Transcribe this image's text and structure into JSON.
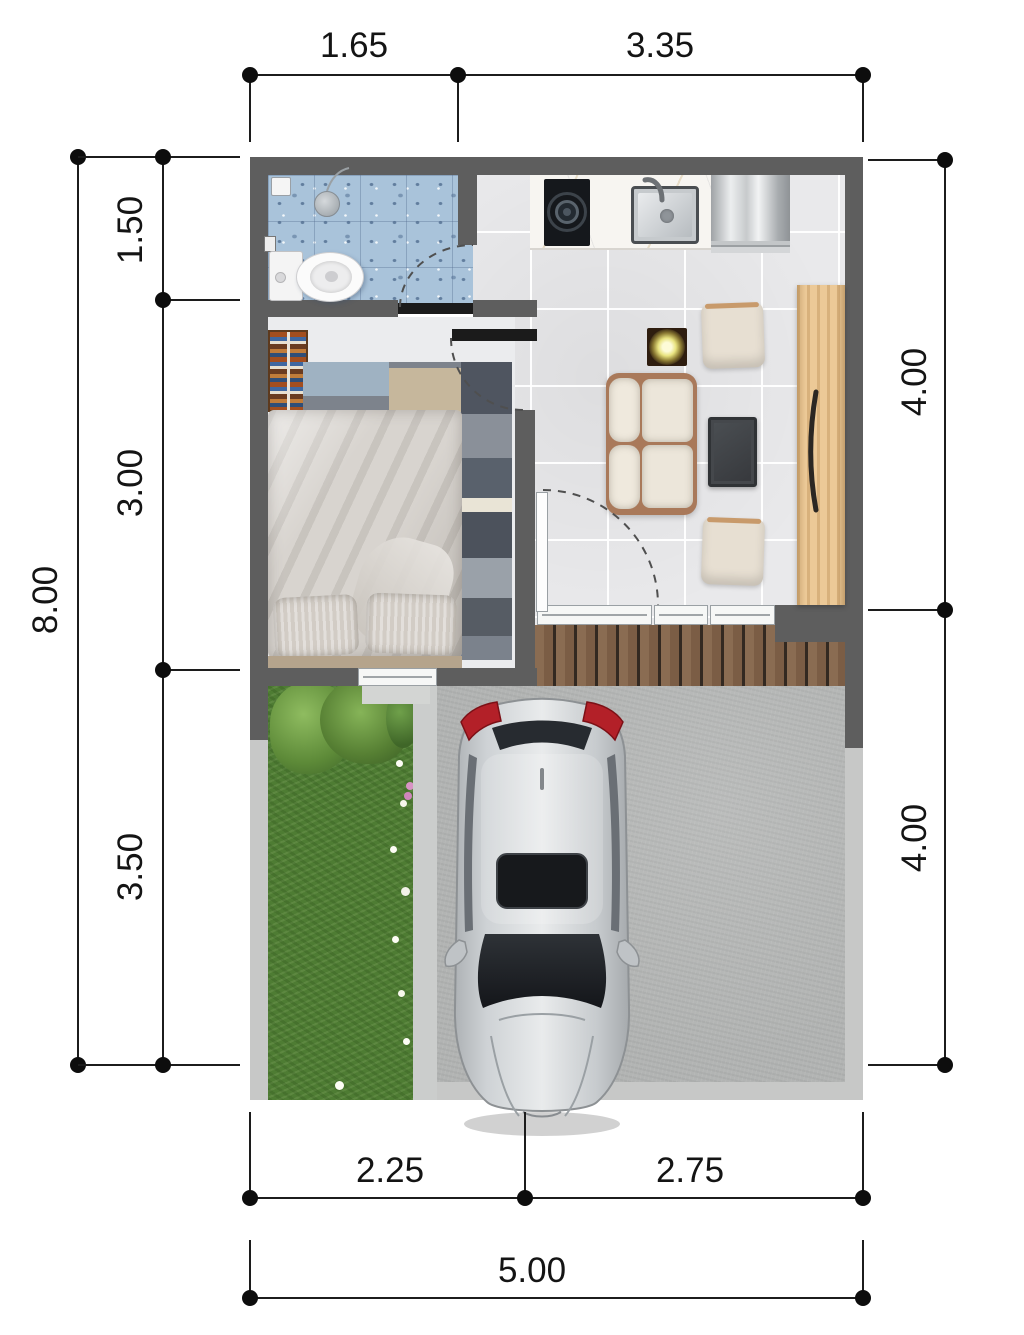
{
  "dimensions": {
    "top": [
      "1.65",
      "3.35"
    ],
    "left_outer": "8.00",
    "left_inner": [
      "1.50",
      "3.00",
      "3.50"
    ],
    "right": [
      "4.00",
      "4.00"
    ],
    "bottom_inner": [
      "2.25",
      "2.75"
    ],
    "bottom_outer": "5.00"
  },
  "colors": {
    "wall_dark": "#5e5e5e",
    "threshold_black": "#1b1b1b",
    "bathroom_tile_blue": "#a9c3da",
    "interior_floor": "#e9e9eb",
    "terrace_wood": "#85684f",
    "wardrobe_wood": "#ecc997",
    "sofa_cream": "#ece6da",
    "garden_grass": "#4e7c33",
    "carport_concrete": "#b2b4b3",
    "boundary_fence": "#c7c8c7",
    "car_body_silver": "#c6cacd",
    "car_taillight_red": "#b32028",
    "dimension_ink": "#141414"
  }
}
